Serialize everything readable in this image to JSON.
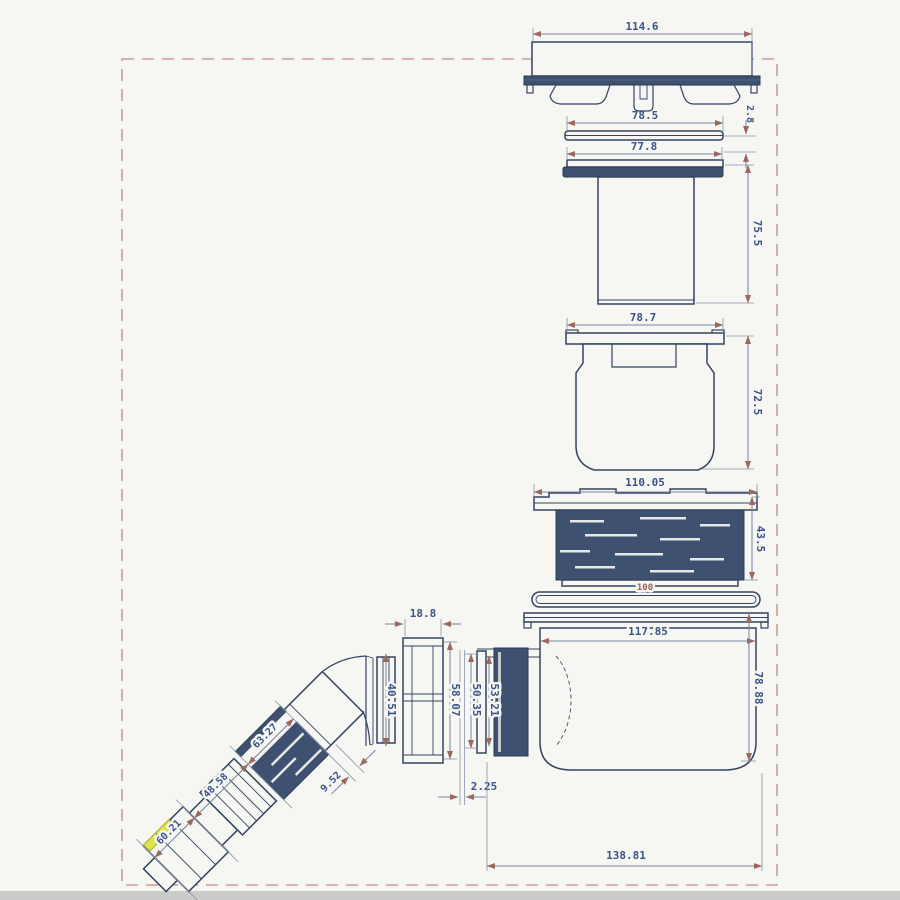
{
  "colors": {
    "background": "#f6f6f3",
    "line": "#34445f",
    "dark_fill": "#3e5170",
    "dimension_line": "#7583a0",
    "arrow": "#9a6a60",
    "label_text": "#3c5289",
    "seal_label_text": "#9a6055",
    "border_dash": "#c79e96",
    "highlight": "#dde24f"
  },
  "drawing": {
    "dims": {
      "cover_width": "114.6",
      "plate_width": "78.5",
      "plate_thickness": "2.8",
      "flange_width": "77.8",
      "waste_body_height": "75.5",
      "insert_width": "78.7",
      "insert_height": "72.5",
      "collar_width": "110.05",
      "collar_height": "43.5",
      "seal_diameter": "100",
      "trap_inner_width": "117.85",
      "trap_height": "78.88",
      "nut_top_width": "18.8",
      "nut_inner_height": "40.51",
      "thread_od": "58.07",
      "washer_od": "50.35",
      "outlet_od": "53.21",
      "seal_thickness": "2.25",
      "overall_length": "138.81",
      "elbow_thread_length": "63.27",
      "elbow_mid_length": "48.58",
      "elbow_end_length": "60.21",
      "elbow_lip": "9.52"
    }
  }
}
